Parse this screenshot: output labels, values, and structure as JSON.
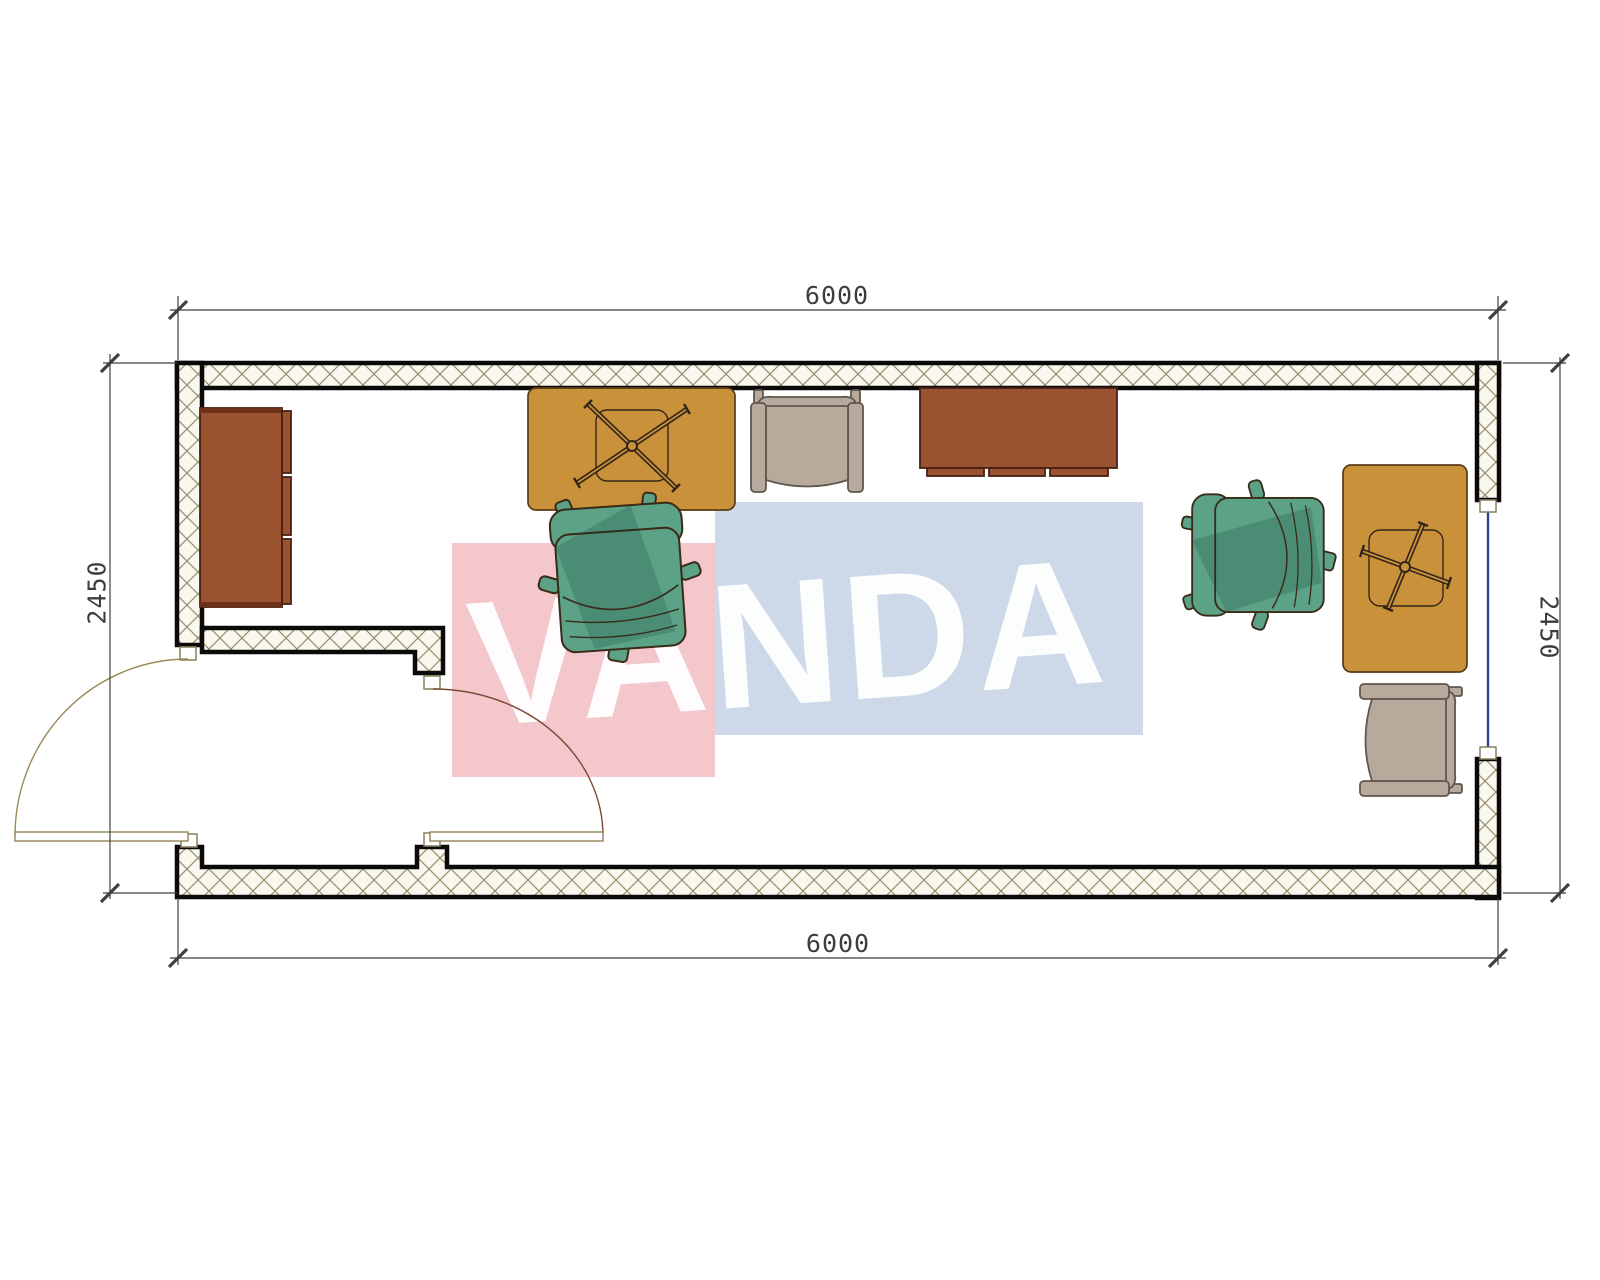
{
  "watermark": {
    "text": "VANDA"
  },
  "dimensions": {
    "top": "6000",
    "bottom": "6000",
    "left": "2450",
    "right": "2450"
  },
  "furniture_blocks": [
    "sideboard-left",
    "desk-with-chair-base-center",
    "armchair-top",
    "tv-stand-top",
    "executive-chair-center",
    "executive-chair-right",
    "desk-with-chair-base-right",
    "armchair-bottom-right",
    "double-swing-entry-doors",
    "window-right"
  ],
  "colors": {
    "wall_line": "#0a0a0a",
    "hatch_bg": "#faf7ee",
    "hatch_line": "#94906f",
    "desk": "#c9923a",
    "desk_edge": "#5a3a14",
    "cabinet": "#9a5330",
    "cabinet_edge": "#4a2013",
    "chair_green": "#5ba287",
    "chair_green_edge": "#3a2a18",
    "chair_gray": "#b7aa9c",
    "chair_gray_edge": "#5f574c",
    "door_arc_left": "#9a8a58",
    "door_arc_right": "#7a4a35",
    "door_leaf": "#8a7b4a",
    "window": "#2b3f9d",
    "jamb_edge": "#8a7e5e",
    "dim_line": "#3f3f3f",
    "dim_text": "#3d3d3d",
    "wm_pink": "#f3c7cc",
    "wm_blue": "#cdd9e9",
    "wm_text": "#ffffff"
  }
}
